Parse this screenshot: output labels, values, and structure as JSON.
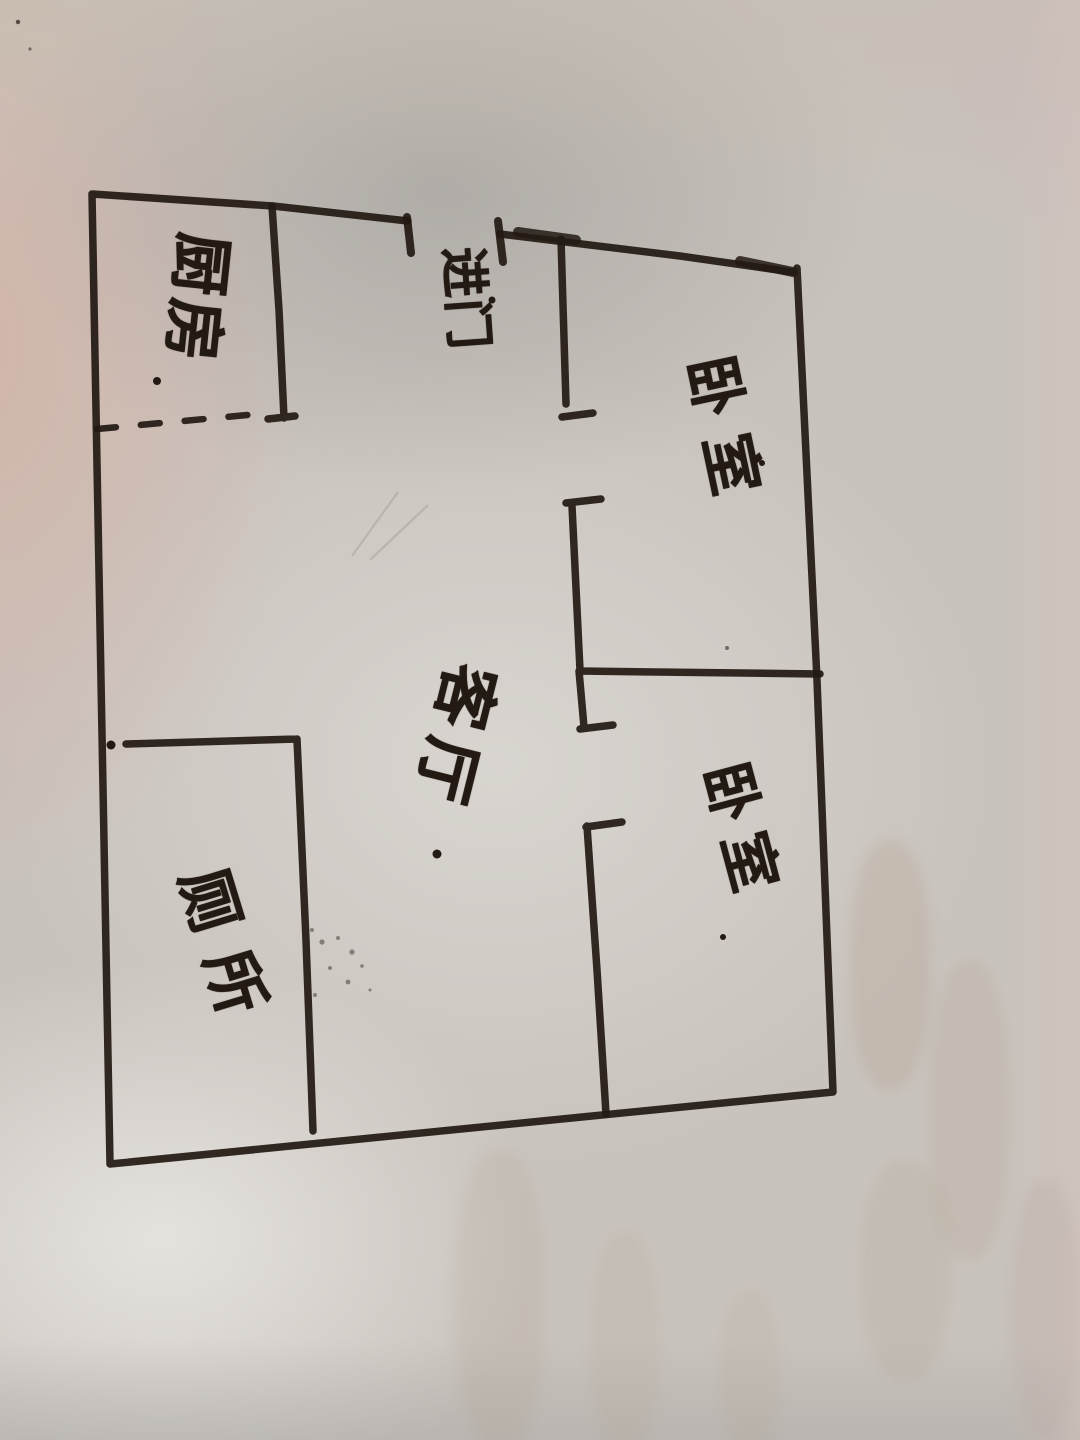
{
  "floor_plan": {
    "paper_color": "#d8d4cf",
    "ink_color": "#221a13",
    "entrance": {
      "label": "进门"
    },
    "rooms": [
      {
        "id": "kitchen",
        "label": "厨房"
      },
      {
        "id": "bedroom-top",
        "label": "卧室"
      },
      {
        "id": "living-room",
        "label": "客厅"
      },
      {
        "id": "bedroom-bottom",
        "label": "卧室"
      },
      {
        "id": "toilet",
        "label": "厕所"
      }
    ]
  }
}
